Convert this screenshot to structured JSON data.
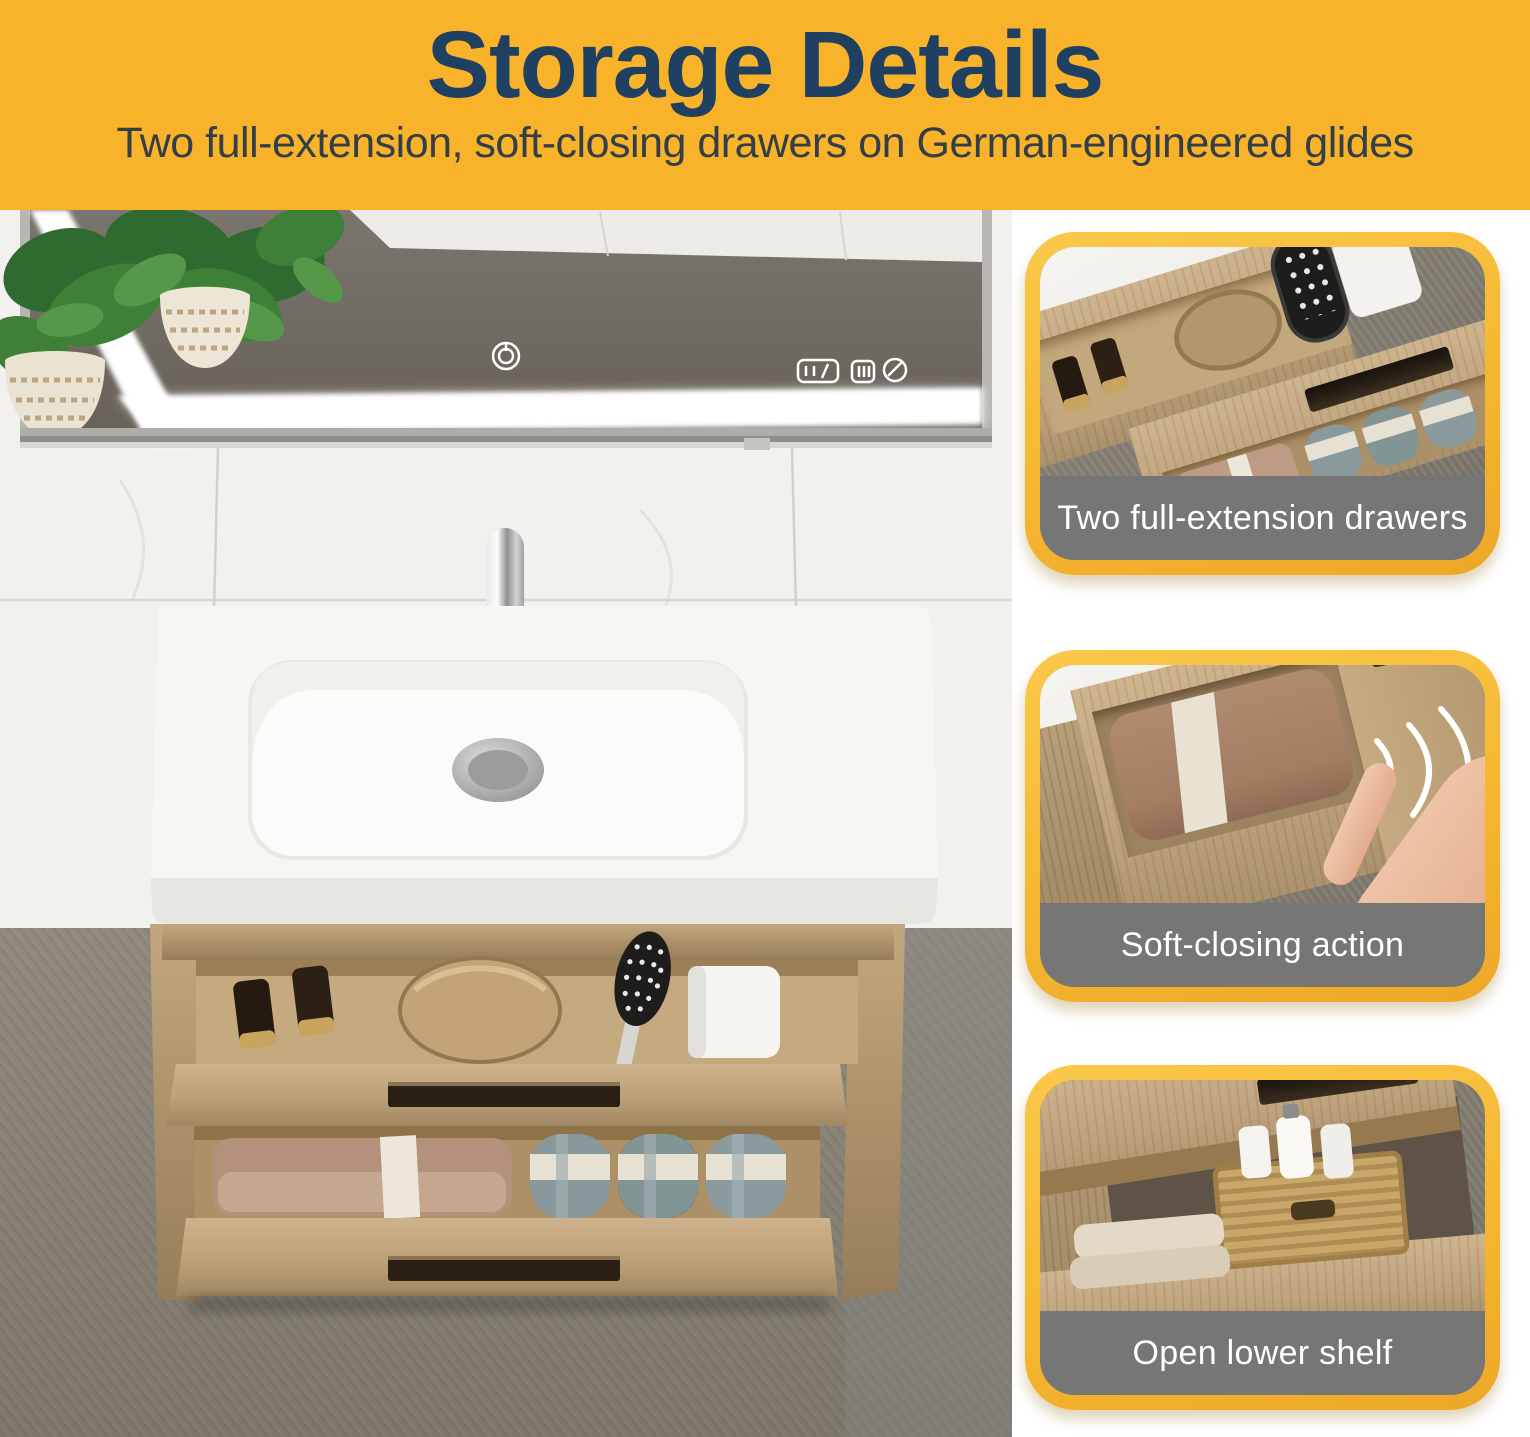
{
  "header": {
    "title": "Storage Details",
    "subtitle": "Two full-extension, soft-closing drawers on German-engineered glides"
  },
  "cards": [
    {
      "caption": "Two full-extension drawers"
    },
    {
      "caption": "Soft-closing action"
    },
    {
      "caption": "Open lower shelf"
    }
  ],
  "main_photo": {
    "mirror_touch_icons": [
      "power-icon",
      "color-temp-adjust-icon",
      "brightness-icon",
      "defog-icon"
    ]
  },
  "colors": {
    "accent_yellow": "#F9B32B",
    "title_navy": "#1F4060",
    "subtitle_dark": "#333F47",
    "caption_gray": "#767676",
    "caption_text": "#FFFFFF",
    "card_border_light": "#FAC84A",
    "wood_oak": "#BCA078",
    "floor_gray": "#8B8579"
  }
}
